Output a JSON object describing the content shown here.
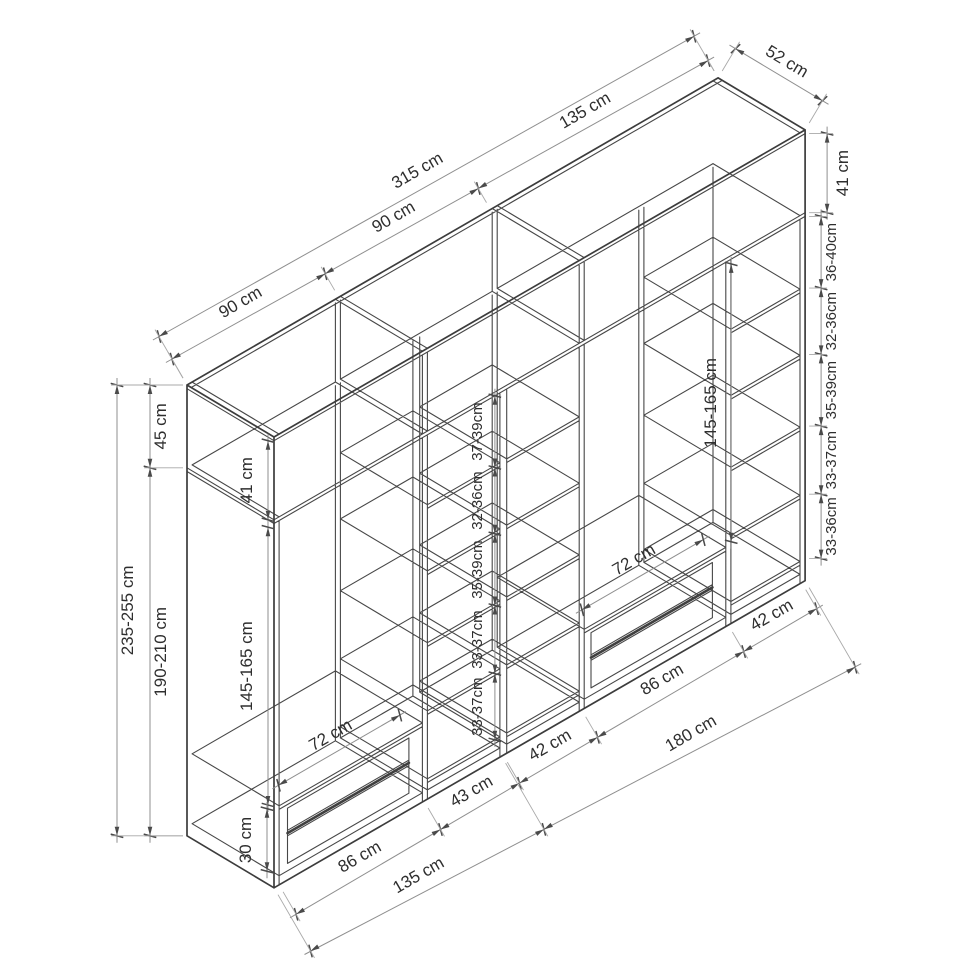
{
  "canvas": {
    "width": 960,
    "height": 960,
    "background": "#ffffff"
  },
  "colors": {
    "structure": "#474747",
    "structure_heavy": "#3c3c3c",
    "dimension_line": "#8f8f8f",
    "extension_line": "#a8a8a8",
    "tick": "#4a4a4a",
    "text": "#2e2e2e"
  },
  "diagram": {
    "projection": {
      "ox": 187,
      "oy": 385,
      "wx": 1.686,
      "wy": -0.975,
      "dx": 1.673,
      "dy": 1.0,
      "vy": 1.84
    },
    "wardrobe": {
      "width_cm": 315,
      "depth_cm": 52,
      "height_cm": 245,
      "upper_height": 45,
      "body_top": 47,
      "floor": 240,
      "bottom": 245,
      "shelf_thickness": 2,
      "upper_dividers": [
        88,
        91,
        181,
        184
      ],
      "upper_compartments": [
        [
          3,
          88
        ],
        [
          91,
          181
        ],
        [
          184,
          312
        ]
      ],
      "divider_faces": [
        3,
        88,
        91,
        134,
        138,
        181,
        184,
        268,
        271,
        312
      ],
      "back_edge_faces": [
        88,
        91,
        134,
        138,
        181,
        184,
        268,
        271,
        312
      ],
      "drawer_top": 202,
      "drawer_front_lines": [
        206,
        218,
        221,
        236
      ],
      "drawer_gap_line": 219.5,
      "drawer_v1": 206,
      "drawer_v2": 236,
      "columns": [
        {
          "id": "bay-left",
          "x1": 3,
          "x2": 88,
          "type": "bay",
          "drawer": [
            8,
            80
          ]
        },
        {
          "id": "shelf-column-1",
          "x1": 91,
          "x2": 134,
          "type": "shelves",
          "shelf_tops": [
            85,
            121,
            160,
            197,
            234
          ]
        },
        {
          "id": "shelf-column-2",
          "x1": 138,
          "x2": 181,
          "type": "shelves",
          "shelf_tops": [
            85,
            121,
            160,
            197,
            234
          ]
        },
        {
          "id": "bay-right",
          "x1": 184,
          "x2": 268,
          "type": "bay",
          "drawer": [
            188,
            260
          ]
        },
        {
          "id": "shelf-column-3",
          "x1": 271,
          "x2": 312,
          "type": "shelves",
          "shelf_tops": [
            85,
            121,
            160,
            197,
            233
          ]
        }
      ]
    },
    "dim_chains_w": [
      {
        "name": "dim-top-bays",
        "d": 0,
        "v": 0,
        "off1": 30,
        "off2": 20,
        "lab": 11,
        "fs": 17,
        "ext": 8,
        "ticks": [
          0,
          90,
          180,
          315
        ],
        "labels": [
          "90 cm",
          "90 cm",
          "135 cm"
        ]
      },
      {
        "name": "dim-top-total",
        "d": 0,
        "v": 0,
        "off1": 56,
        "off2": 48,
        "lab": 13,
        "fs": 17,
        "ext": 8,
        "ticks": [
          0,
          315
        ],
        "labels": [
          "315 cm"
        ]
      },
      {
        "name": "dim-bottom-interiors",
        "d": 52,
        "v": 245,
        "off1": -34,
        "off2": -30,
        "lab": 12,
        "fs": 17,
        "ext": -8,
        "ticks": [
          3,
          89,
          136,
          182.5,
          269.5,
          313
        ],
        "labels": [
          "86 cm",
          "43 cm",
          "42 cm",
          "86 cm",
          "42 cm"
        ]
      },
      {
        "name": "dim-bottom-modules",
        "d": 52,
        "v": 245,
        "off1": -73,
        "off2": -100,
        "lab": 12,
        "fs": 17,
        "ext": -8,
        "ticks": [
          0,
          135,
          315
        ],
        "labels": [
          "135 cm",
          "180 cm"
        ]
      },
      {
        "name": "dim-drawer-left",
        "d": 52,
        "v": 202,
        "off1": 18,
        "off2": 18,
        "lab": 12,
        "fs": 17,
        "ticks": [
          8,
          80
        ],
        "labels": [
          "72 cm"
        ]
      },
      {
        "name": "dim-drawer-right",
        "d": 52,
        "v": 202,
        "off1": 18,
        "off2": 18,
        "lab": 12,
        "fs": 17,
        "ticks": [
          188,
          260
        ],
        "labels": [
          "72 cm"
        ]
      }
    ],
    "dim_depth": [
      {
        "name": "dim-depth",
        "w": 315,
        "v": 0,
        "d1": 0,
        "d2": 52,
        "off": 34,
        "lab": 10,
        "fs": 17,
        "ext": 8,
        "label": "52 cm"
      }
    ],
    "dim_chains_v": [
      {
        "name": "dim-right-upper",
        "w": 315,
        "d": 52,
        "xoff": 22,
        "lab_dx": 21,
        "fs": 17,
        "ext": true,
        "ticks": [
          2,
          45
        ],
        "labels": [
          "41 cm"
        ]
      },
      {
        "name": "dim-right-gaps",
        "w": 315,
        "d": 52,
        "xoff": 16,
        "lab_dx": 15,
        "fs": 15,
        "ext": true,
        "ticks": [
          47,
          86,
          122,
          161,
          198,
          233
        ],
        "labels": [
          "36-40cm",
          "32-36cm",
          "35-39cm",
          "33-37cm",
          "33-36cm"
        ]
      },
      {
        "name": "dim-left-total",
        "w": 0,
        "d": 0,
        "xoff": -70,
        "lab_dx": 16,
        "fs": 17,
        "ext": true,
        "ticks": [
          0,
          245
        ],
        "labels": [
          "235-255 cm"
        ]
      },
      {
        "name": "dim-left-split",
        "w": 0,
        "d": 0,
        "xoff": -37,
        "lab_dx": 16,
        "fs": 17,
        "ext": true,
        "ticks": [
          0,
          45,
          245
        ],
        "labels": [
          "45 cm",
          "190-210 cm"
        ]
      },
      {
        "name": "dim-left-upper-interior",
        "w": 0,
        "d": 52,
        "xoff": -6,
        "lab_dx": -16,
        "fs": 17,
        "ext": false,
        "ticks": [
          2,
          45
        ],
        "labels": [
          "41 cm"
        ]
      },
      {
        "name": "dim-left-hanging",
        "w": 0,
        "d": 52,
        "xoff": -6,
        "lab_dx": -16,
        "fs": 17,
        "ext": false,
        "ticks": [
          49,
          200
        ],
        "labels": [
          "145-165 cm"
        ]
      },
      {
        "name": "dim-left-drawerzone",
        "w": 0,
        "d": 52,
        "xoff": -7,
        "lab_dx": -16,
        "fs": 17,
        "ext": false,
        "ticks": [
          202,
          236
        ],
        "labels": [
          "30 cm"
        ]
      },
      {
        "name": "dim-middle-gaps",
        "w": 131,
        "d": 52,
        "xoff": 0,
        "lab_dx": -13,
        "fs": 15,
        "ext": false,
        "ticks": [
          47,
          86,
          122,
          161,
          198,
          234
        ],
        "labels": [
          "37-39cm",
          "32-36cm",
          "35-39cm",
          "33-37cm",
          "33-37cm"
        ]
      },
      {
        "name": "dim-right-hanging",
        "w": 270,
        "d": 52,
        "xoff": 2,
        "lab_dx": -15,
        "fs": 17,
        "ext": false,
        "ticks": [
          49,
          200
        ],
        "labels": [
          "145-165 cm"
        ]
      }
    ]
  }
}
